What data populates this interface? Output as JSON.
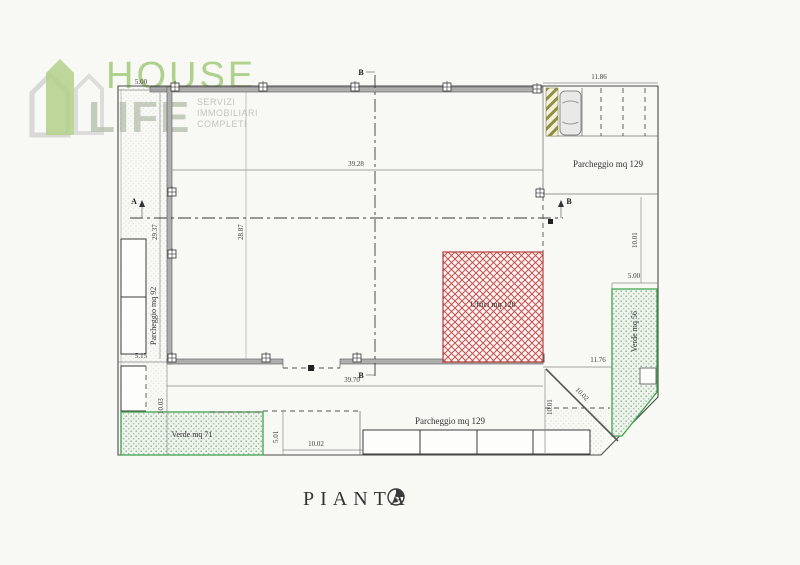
{
  "logo": {
    "brand_top": "HOUSE",
    "brand_bottom": "LIFE",
    "tag1": "SERVIZI",
    "tag2": "IMMOBILIARI",
    "tag3": "COMPLETI"
  },
  "plan": {
    "title": "PIANTA",
    "areas": {
      "uffici": "Uffici mq 120",
      "verde_sw": "Verde mq 71",
      "verde_e": "Verde mq 56",
      "parcheggio_w": "Parcheggio mq 92",
      "parcheggio_ne": "Parcheggio mq 129",
      "parcheggio_s": "Parcheggio mq 129"
    },
    "dimensions": {
      "nw_offset": "5.00",
      "ne_width": "11.86",
      "hall_width_top": "39.28",
      "hall_width_bottom": "39.70",
      "hall_height_outer": "29.37",
      "hall_height_inner": "28.87",
      "east_upper": "10.01",
      "east_mid": "5.00",
      "east_lower": "11.76",
      "diagonal": "10.02",
      "south_east": "10.01",
      "south_center": "10.02",
      "south_west": "10.03",
      "west_lower": "5.15",
      "verde_sw_side": "5.01"
    },
    "sections": {
      "a": "A",
      "b": "B"
    }
  },
  "colors": {
    "accent_green": "#a2cb79",
    "uffici_hatch_red": "#c4524e",
    "verde_green": "#3fa34d",
    "ramp_olive": "#8f8f42"
  }
}
